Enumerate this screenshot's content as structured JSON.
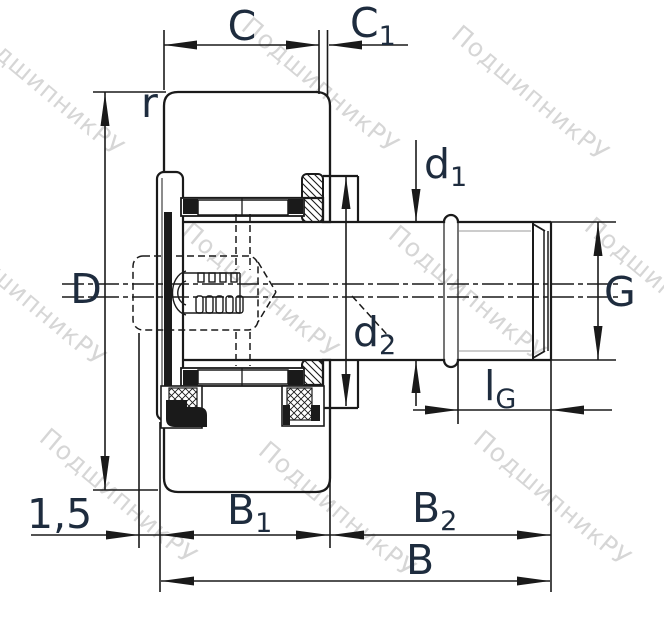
{
  "drawing": {
    "type": "bearing-cross-section",
    "part": "stud-type track roller cam follower"
  },
  "watermark": {
    "text": "ПодшипникРУ"
  },
  "dimensions": {
    "c": {
      "label": "C"
    },
    "c1": {
      "base": "C",
      "sub": "1"
    },
    "r": {
      "label": "r"
    },
    "d_outer": {
      "label": "D"
    },
    "d1": {
      "base": "d",
      "sub": "1"
    },
    "d2": {
      "base": "d",
      "sub": "2"
    },
    "g": {
      "label": "G"
    },
    "lg": {
      "base": "l",
      "sub": "G"
    },
    "b1": {
      "base": "B",
      "sub": "1"
    },
    "b2": {
      "base": "B",
      "sub": "2"
    },
    "b": {
      "label": "B"
    },
    "chamfer": {
      "label": "1,5"
    }
  },
  "colors": {
    "line": "#1a1a1a",
    "label": "#1e2c3e",
    "watermark": "#b5b5b5"
  }
}
